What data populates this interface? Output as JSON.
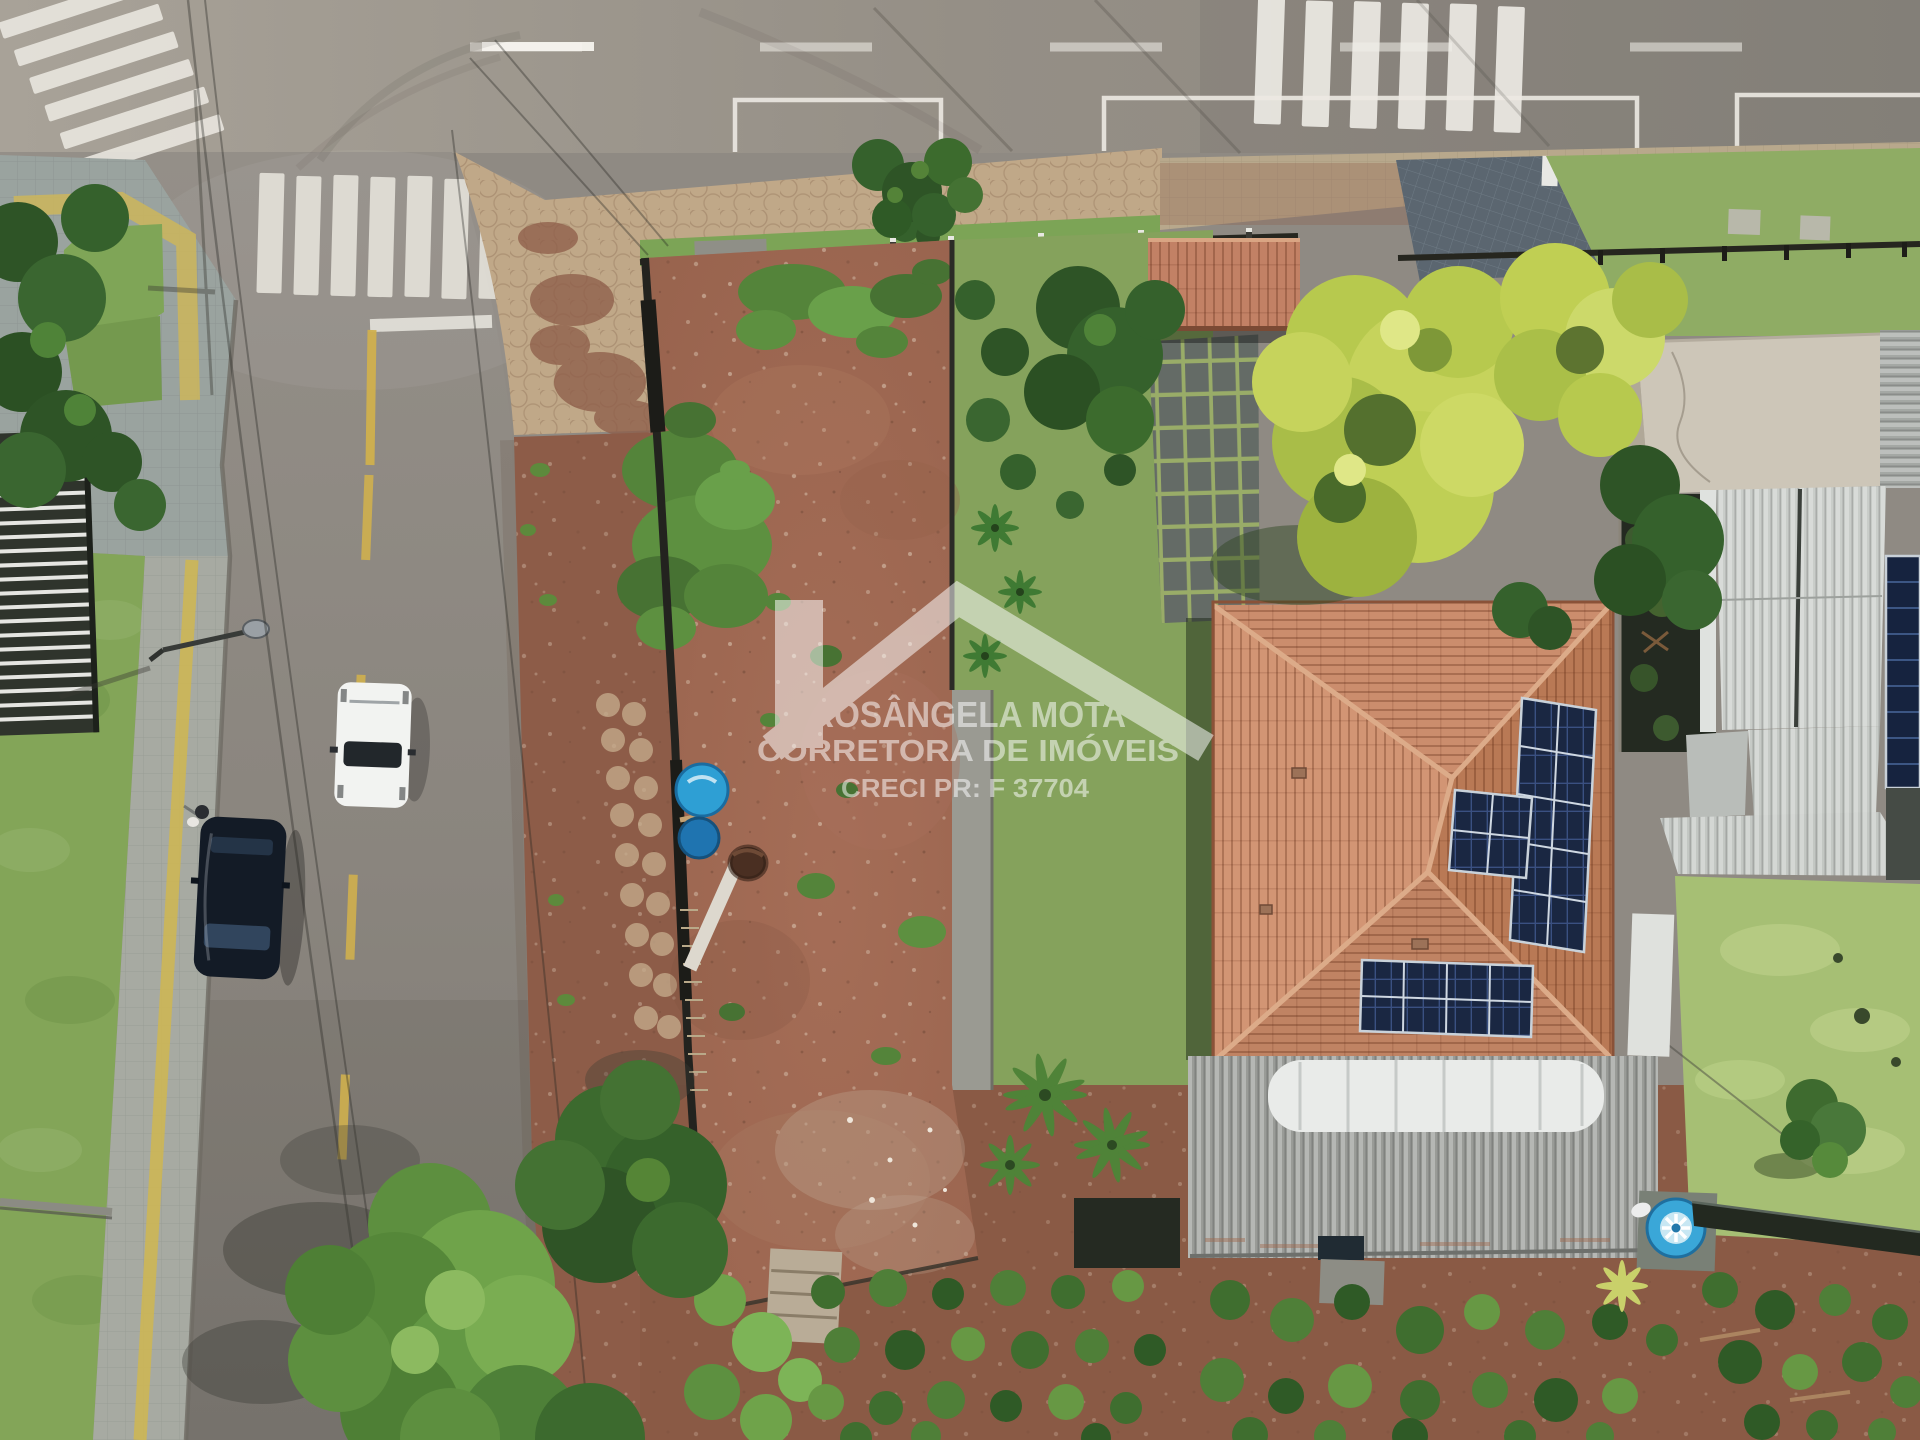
{
  "image_type": "aerial-drone-photo",
  "watermark": {
    "logo": "house-roof-logo",
    "line1": "ROSÂNGELA MOTA",
    "line2": "CORRETORA DE IMÓVEIS",
    "line3": "CRECI PR: F 37704",
    "color": "#ffffff",
    "opacity": 0.52
  },
  "palette": {
    "asphalt": "#938e86",
    "asphalt_dark": "#847f79",
    "dirt_lot": "#9e6852",
    "dirt_shoulder": "#8d5c48",
    "lawn": "#83a558",
    "lawn_right": "#a6bf74",
    "grass_strip": "#7ca456",
    "tree_dark": "#2f5426",
    "tree_light": "#6fa34a",
    "tree_yellow": "#bfcf55",
    "roof_terracotta": "#cb8d6d",
    "roof_metal": "#999b97",
    "solar_panel": "#1a2742",
    "sidewalk_tan": "#c0a888",
    "sidewalk_gray": "#a7aaa2",
    "paver_blue": "#5b6670",
    "road_paint_white": "#ece9e2",
    "road_paint_yellow": "#d0b04e",
    "water_tank_blue": "#3aa7d8",
    "barrel_blue": "#2e9fd4",
    "slab_beige": "#cdc6b8",
    "white_car": "#f2f3f1",
    "dark_car": "#131b26"
  },
  "objects": [
    "vacant red-dirt corner lot (photo subject)",
    "house with terracotta hip roof and rooftop solar panels",
    "gray corrugated annex roof with curved white skylight",
    "blue water tank",
    "blue water barrels inside lot",
    "white car driving on the street",
    "dark parked car",
    "person standing at the curb",
    "street lamp over the road",
    "pedestrian crosswalks and parking-bay road markings",
    "tree canopies and garden with planted rows",
    "neighboring modern houses with metal roofs"
  ]
}
